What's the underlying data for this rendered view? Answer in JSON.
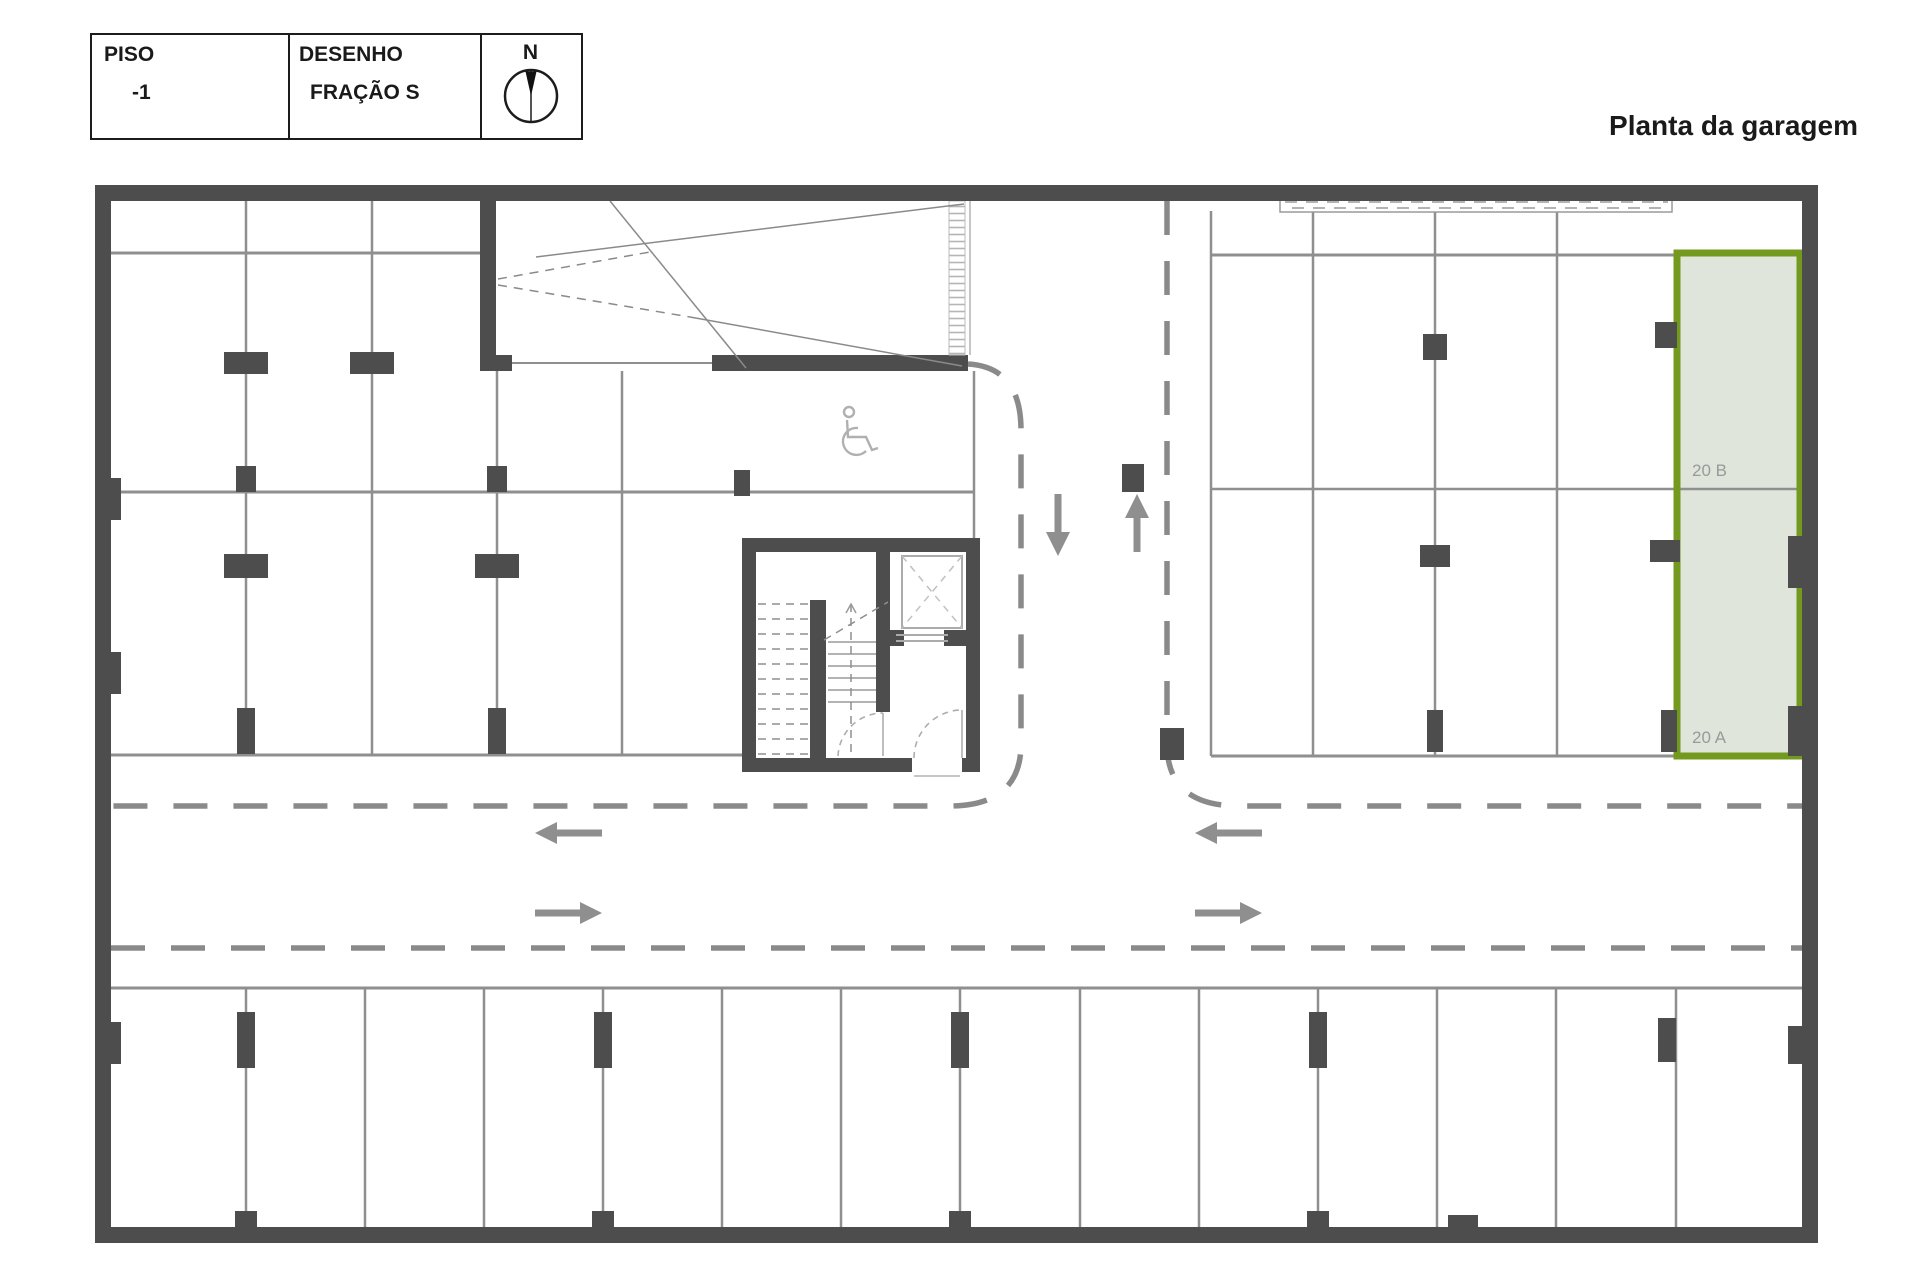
{
  "page_title": "Planta da garagem",
  "title_block": {
    "floor_label": "PISO",
    "floor_value": "-1",
    "drawing_label": "DESENHO",
    "drawing_value": "FRAÇÃO S",
    "north_label": "N"
  },
  "plan": {
    "type": "garage-floor-plan",
    "highlighted_spaces": [
      {
        "id": "20 B"
      },
      {
        "id": "20 A"
      }
    ],
    "icons": [
      "north-compass-icon",
      "wheelchair-icon",
      "lane-arrows"
    ]
  },
  "colors": {
    "wall": "#4d4d4d",
    "line": "#8f8f8f",
    "lane_dash": "#8a8a8a",
    "arrow": "#8f8f8f",
    "highlight_border": "#74991f",
    "highlight_fill": "#dfe5da",
    "space_label": "#9a9a9a",
    "text": "#1a1a1a"
  }
}
